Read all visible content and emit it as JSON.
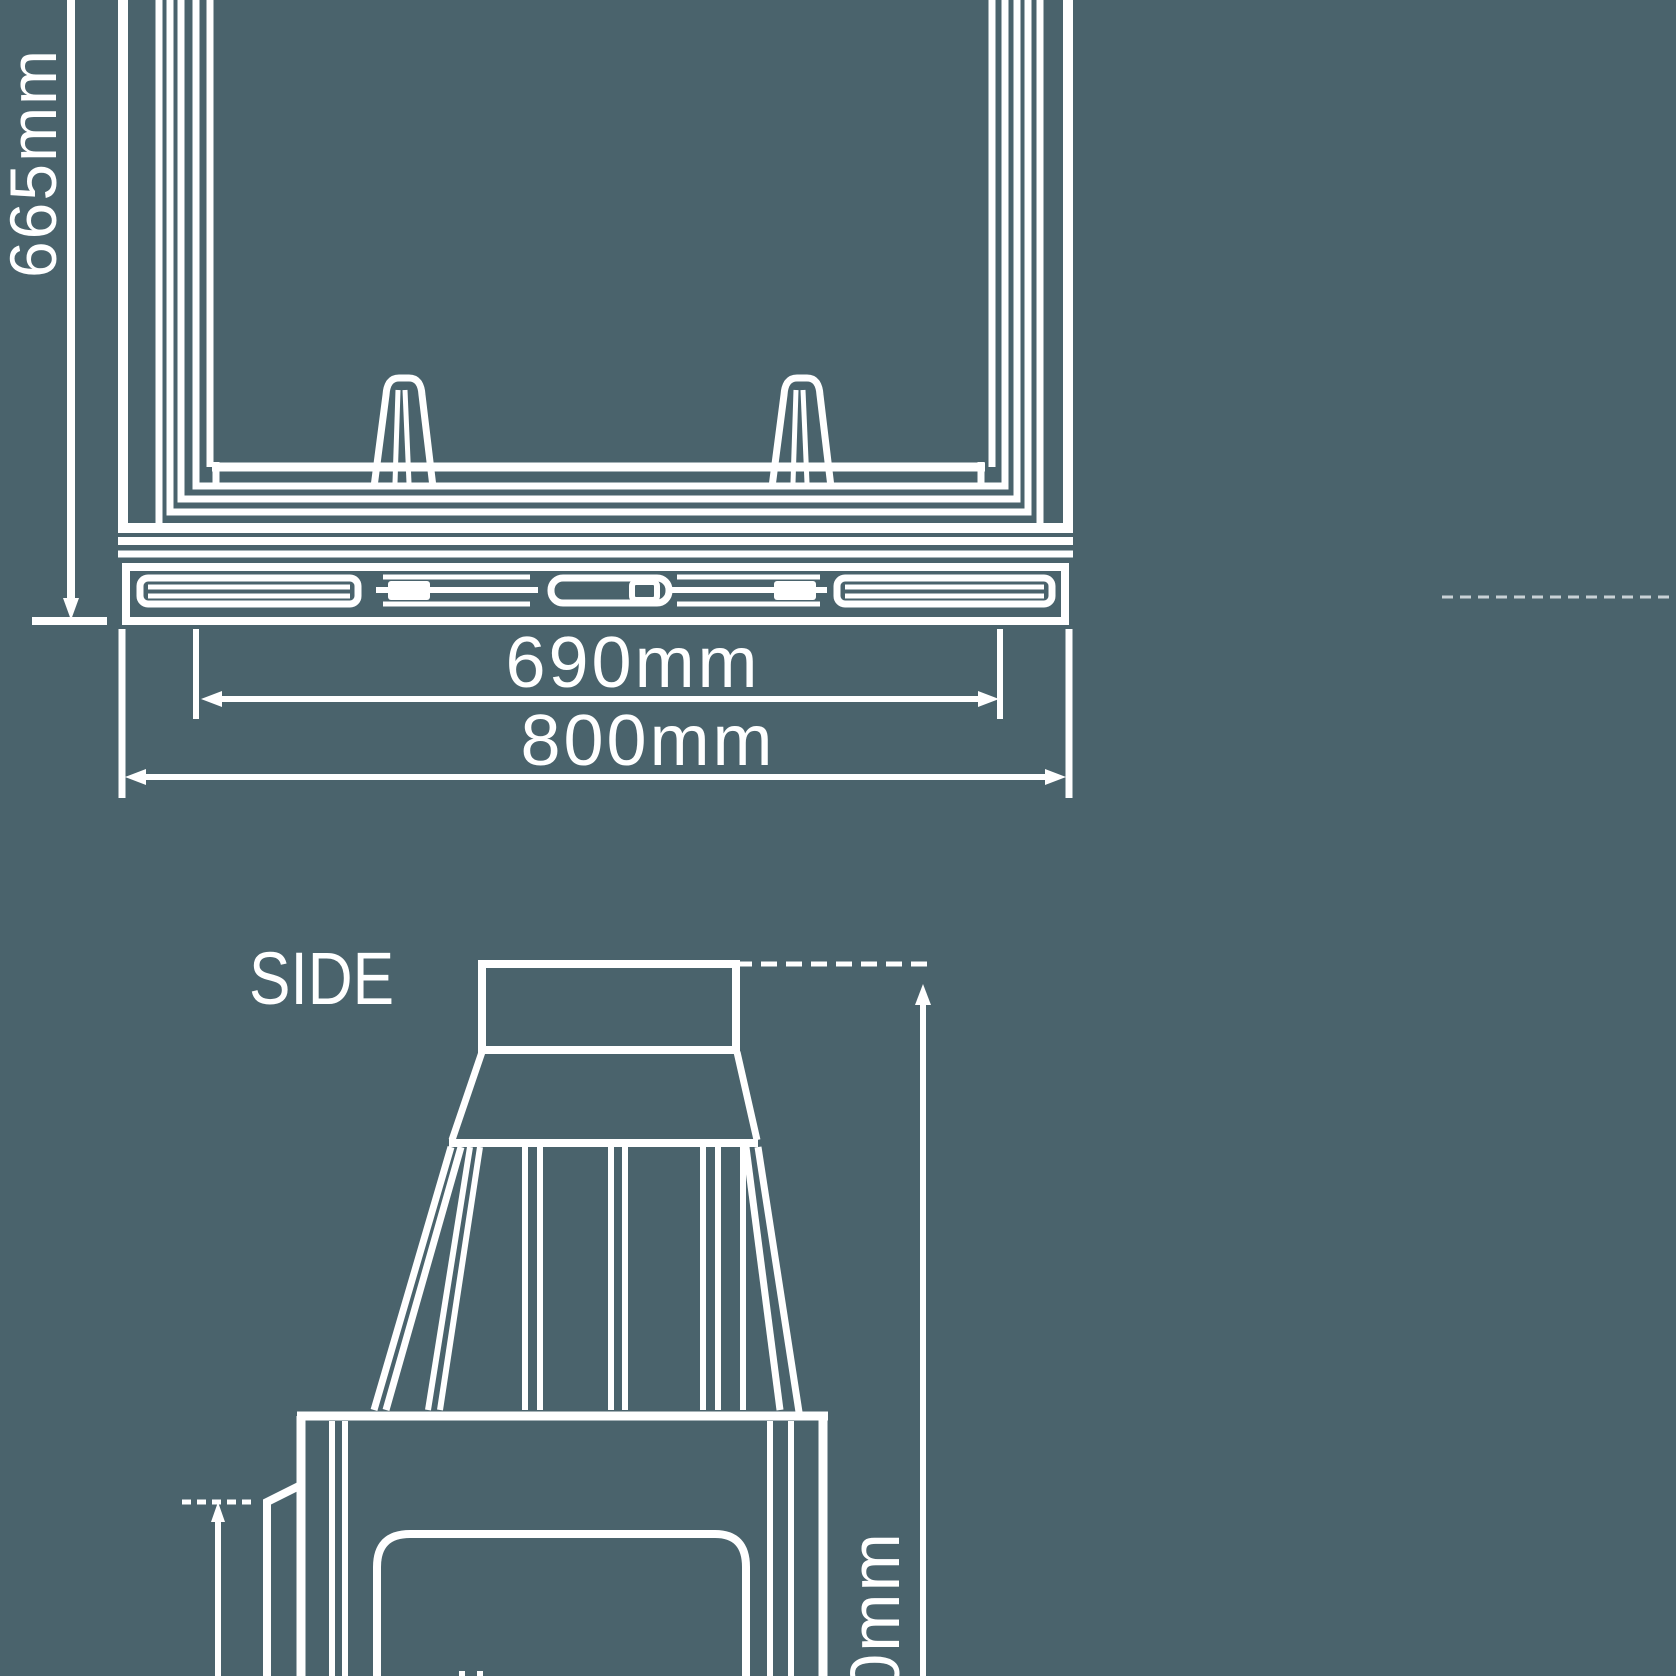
{
  "page": {
    "background": "#4a636c",
    "line_color": "#ffffff",
    "faint_line_color": "#c9d2d6"
  },
  "front_view": {
    "height_dim": "665mm",
    "inner_width_dim": "690mm",
    "outer_width_dim": "800mm"
  },
  "side_view": {
    "label": "SIDE",
    "height_dim_partial": "0mm"
  }
}
